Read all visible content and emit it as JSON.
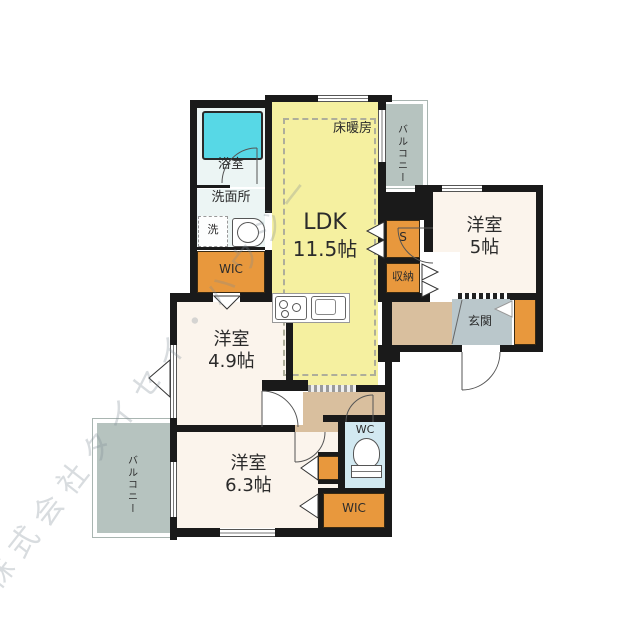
{
  "watermark": "株式会社タイセイ・ハウジー",
  "colors": {
    "wall": "#1a1a1a",
    "ldk_fill": "#f5f0a0",
    "room_fill": "#fbf4ec",
    "closet_orange": "#e8983d",
    "balcony_gray": "#b6c3bf",
    "entrance_gray": "#bac7cb",
    "hall_tan": "#d9bf9e",
    "wc_blue": "#d2e9f1",
    "bath_blue": "#ecf5f4",
    "tub_cyan": "#57d8e6"
  },
  "rooms": {
    "bath": "浴室",
    "washroom": "洗面所",
    "washer": "洗",
    "wic_top": "WIC",
    "ldk_name": "LDK",
    "ldk_area": "11.5帖",
    "floor_heating": "床暖房",
    "balcony_top": "バルコニー",
    "bedroom_east_name": "洋室",
    "bedroom_east_area": "5帖",
    "closet_s": "S",
    "closet_storage": "収納",
    "entrance": "玄関",
    "bedroom_west_name": "洋室",
    "bedroom_west_area": "4.9帖",
    "balcony_west": "バルコニー",
    "bedroom_south_name": "洋室",
    "bedroom_south_area": "6.3帖",
    "wc": "WC",
    "wic_bottom": "WIC"
  }
}
